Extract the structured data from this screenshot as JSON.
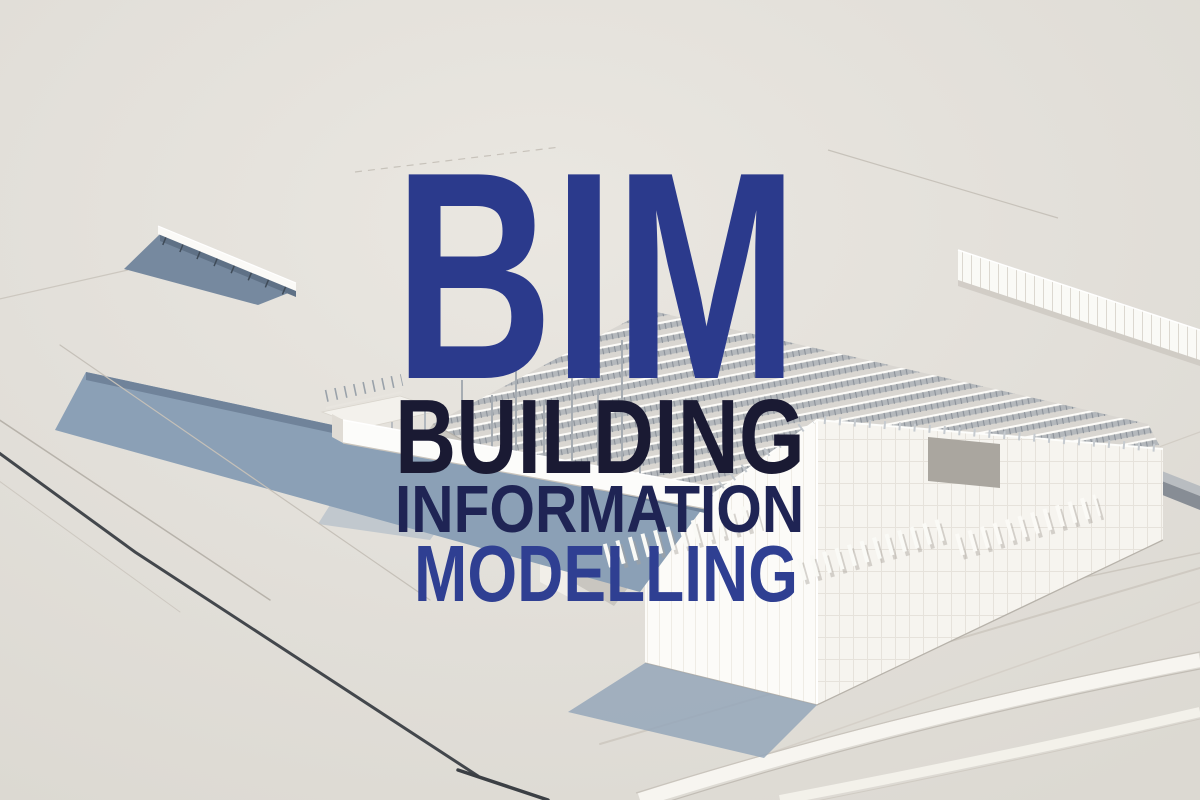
{
  "title_block": {
    "acronym": "BIM",
    "lines": [
      "BUILDING",
      "INFORMATION",
      "MODELLING"
    ]
  },
  "colors": {
    "background": "#e0ddd7",
    "acronym_blue": "#2b3a8c",
    "building_navy": "#1a1a33",
    "information_navy": "#1f2454",
    "modelling_blue": "#2f3f92",
    "model_white": "#fafaf7",
    "shadow_blue": "#8ba0b6"
  },
  "scene": {
    "alt": "Aerial isometric white 3D architectural model of a building under construction"
  }
}
